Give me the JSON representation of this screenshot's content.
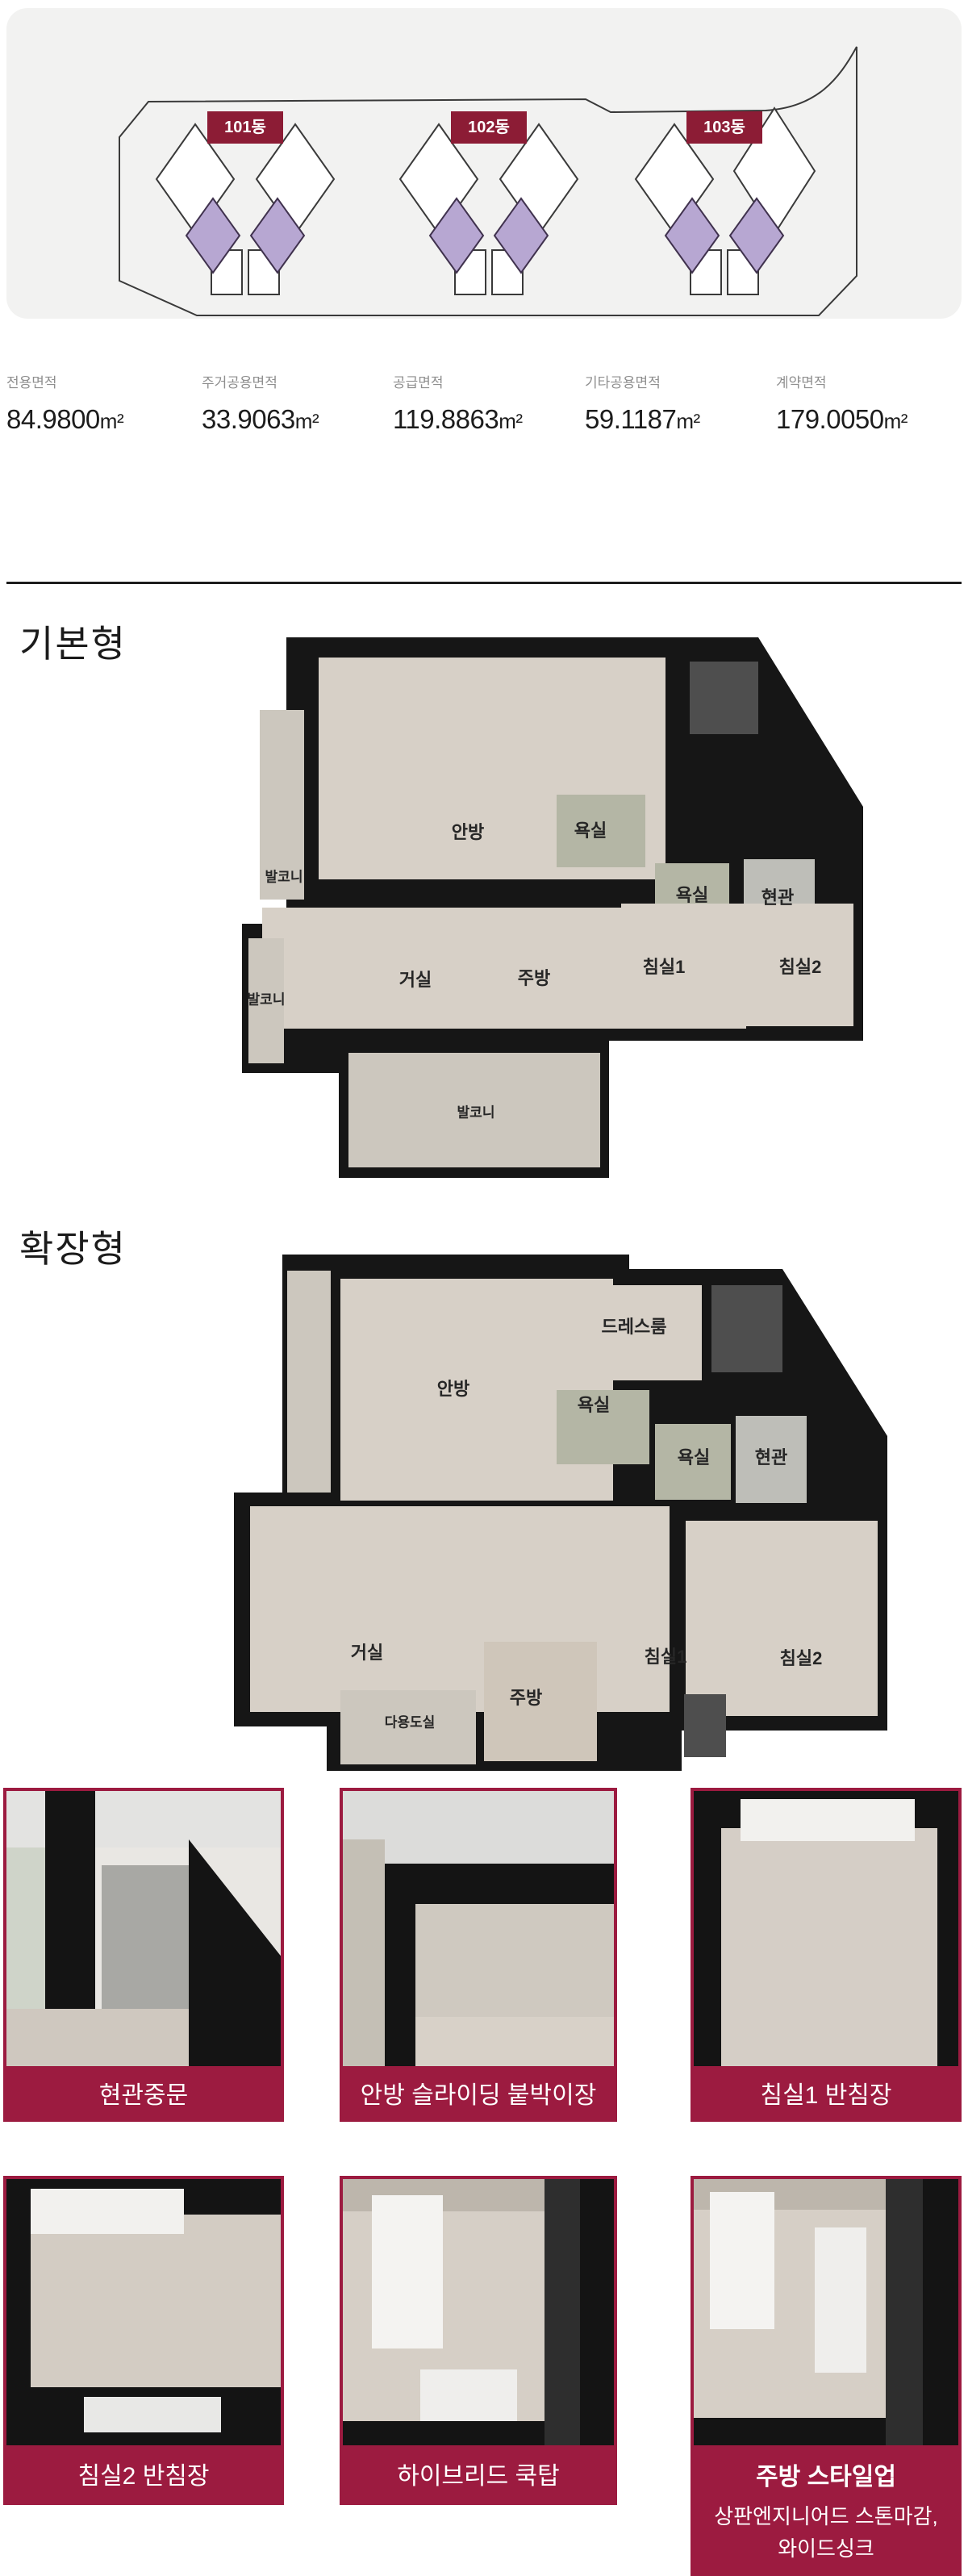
{
  "site": {
    "buildings": [
      {
        "label": "101동"
      },
      {
        "label": "102동"
      },
      {
        "label": "103동"
      }
    ],
    "badge_color": "#8C1C35",
    "tower_fill": "#FFFFFF",
    "annex_fill": "#B7A7D2",
    "outline_color": "#3A3A3A",
    "card_bg": "#F2F2F1"
  },
  "area": {
    "items": [
      {
        "label": "전용면적",
        "value": "84.9800",
        "unit": "m²"
      },
      {
        "label": "주거공용면적",
        "value": "33.9063",
        "unit": "m²"
      },
      {
        "label": "공급면적",
        "value": "119.8863",
        "unit": "m²"
      },
      {
        "label": "기타공용면적",
        "value": "59.1187",
        "unit": "m²"
      },
      {
        "label": "계약면적",
        "value": "179.0050",
        "unit": "m²"
      }
    ]
  },
  "plans": {
    "basic": {
      "title": "기본형",
      "rooms": [
        {
          "label": "안방"
        },
        {
          "label": "발코니"
        },
        {
          "label": "욕실"
        },
        {
          "label": "욕실"
        },
        {
          "label": "현관"
        },
        {
          "label": "발코니"
        },
        {
          "label": "거실"
        },
        {
          "label": "주방"
        },
        {
          "label": "침실1"
        },
        {
          "label": "침실2"
        },
        {
          "label": "발코니"
        }
      ]
    },
    "extended": {
      "title": "확장형",
      "rooms": [
        {
          "label": "드레스룸"
        },
        {
          "label": "안방"
        },
        {
          "label": "욕실"
        },
        {
          "label": "욕실"
        },
        {
          "label": "현관"
        },
        {
          "label": "거실"
        },
        {
          "label": "침실1"
        },
        {
          "label": "침실2"
        },
        {
          "label": "주방"
        },
        {
          "label": "다용도실"
        }
      ]
    }
  },
  "cards": {
    "accent_color": "#9C1B40",
    "row1": [
      {
        "caption": "현관중문"
      },
      {
        "caption": "안방 슬라이딩 붙박이장"
      },
      {
        "caption": "침실1 반침장"
      }
    ],
    "row2": [
      {
        "caption": "침실2 반침장"
      },
      {
        "caption": "하이브리드 쿡탑"
      },
      {
        "title": "주방 스타일업",
        "line1": "상판엔지니어드 스톤마감,",
        "line2": "와이드싱크"
      }
    ]
  }
}
